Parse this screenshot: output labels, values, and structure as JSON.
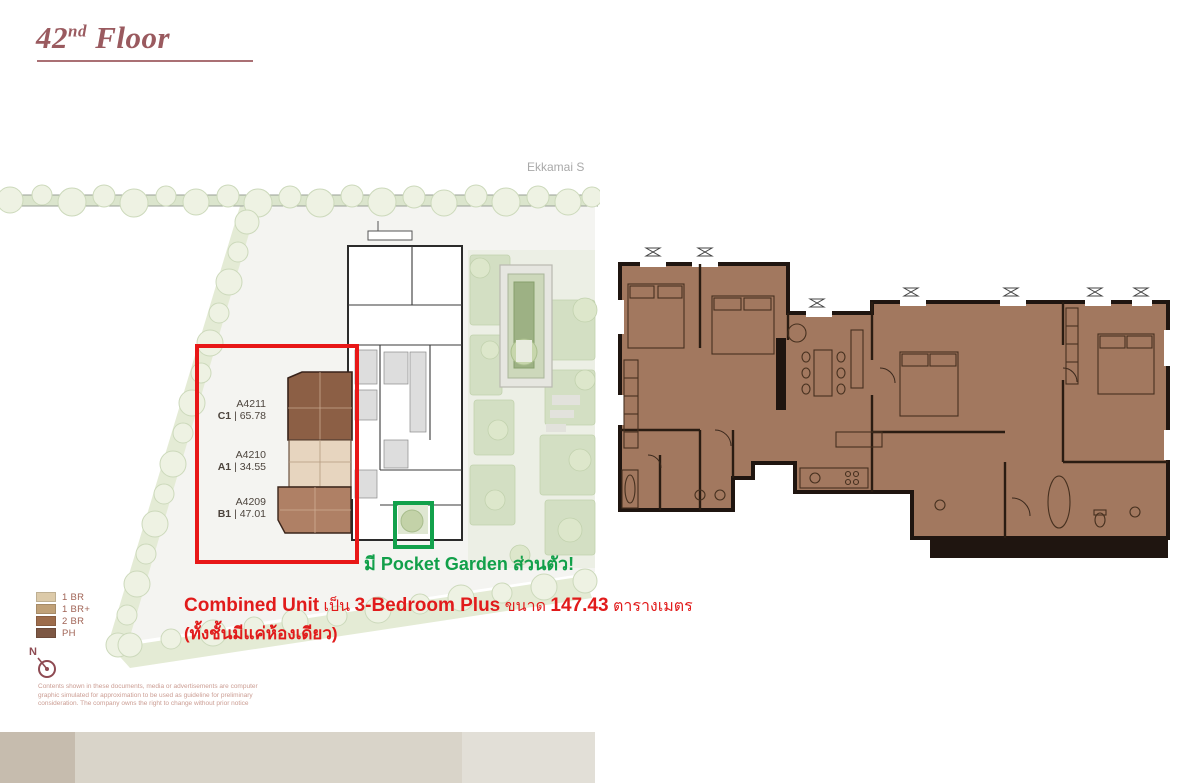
{
  "page": {
    "title": {
      "num": "42",
      "sup": "nd",
      "word": " Floor"
    }
  },
  "site_plan": {
    "street_label": "Ekkamai S",
    "units": [
      {
        "id": "A4211",
        "type": "C1",
        "sep": " | ",
        "area": "65.78"
      },
      {
        "id": "A4210",
        "type": "A1",
        "sep": " | ",
        "area": "34.55"
      },
      {
        "id": "A4209",
        "type": "B1",
        "sep": " | ",
        "area": "47.01"
      }
    ],
    "legend": {
      "items": [
        {
          "label": "1 BR",
          "color": "#dccaa9"
        },
        {
          "label": "1 BR+",
          "color": "#c0a178"
        },
        {
          "label": "2 BR",
          "color": "#9d6c4b"
        },
        {
          "label": "PH",
          "color": "#7d5743"
        }
      ]
    },
    "compass": {
      "label": "N"
    }
  },
  "annotations": {
    "accent_red": "#e11b1b",
    "accent_green": "#12a04a",
    "pocket_garden": {
      "seg1": "มี ",
      "seg2": "Pocket Garden",
      "seg3": " ส่วนตัว!"
    },
    "combined_unit": {
      "seg1": "Combined Unit",
      "seg2": " เป็น ",
      "seg3": "3-Bedroom Plus",
      "seg4": " ขนาด ",
      "seg5": "147.43",
      "seg6": " ตารางเมตร",
      "line2": "(ทั้งชั้นมีแค่ห้องเดียว)"
    }
  },
  "disclaimer": {
    "lines": [
      "Contents shown in these documents, media or advertisements are computer",
      "graphic simulated for approximation to be used as guideline for preliminary",
      "consideration. The company owns the right to change without prior notice"
    ]
  },
  "footer_strip": {
    "colors": [
      "#c6bcae",
      "#d9d4c9",
      "#e2dfd7"
    ]
  }
}
